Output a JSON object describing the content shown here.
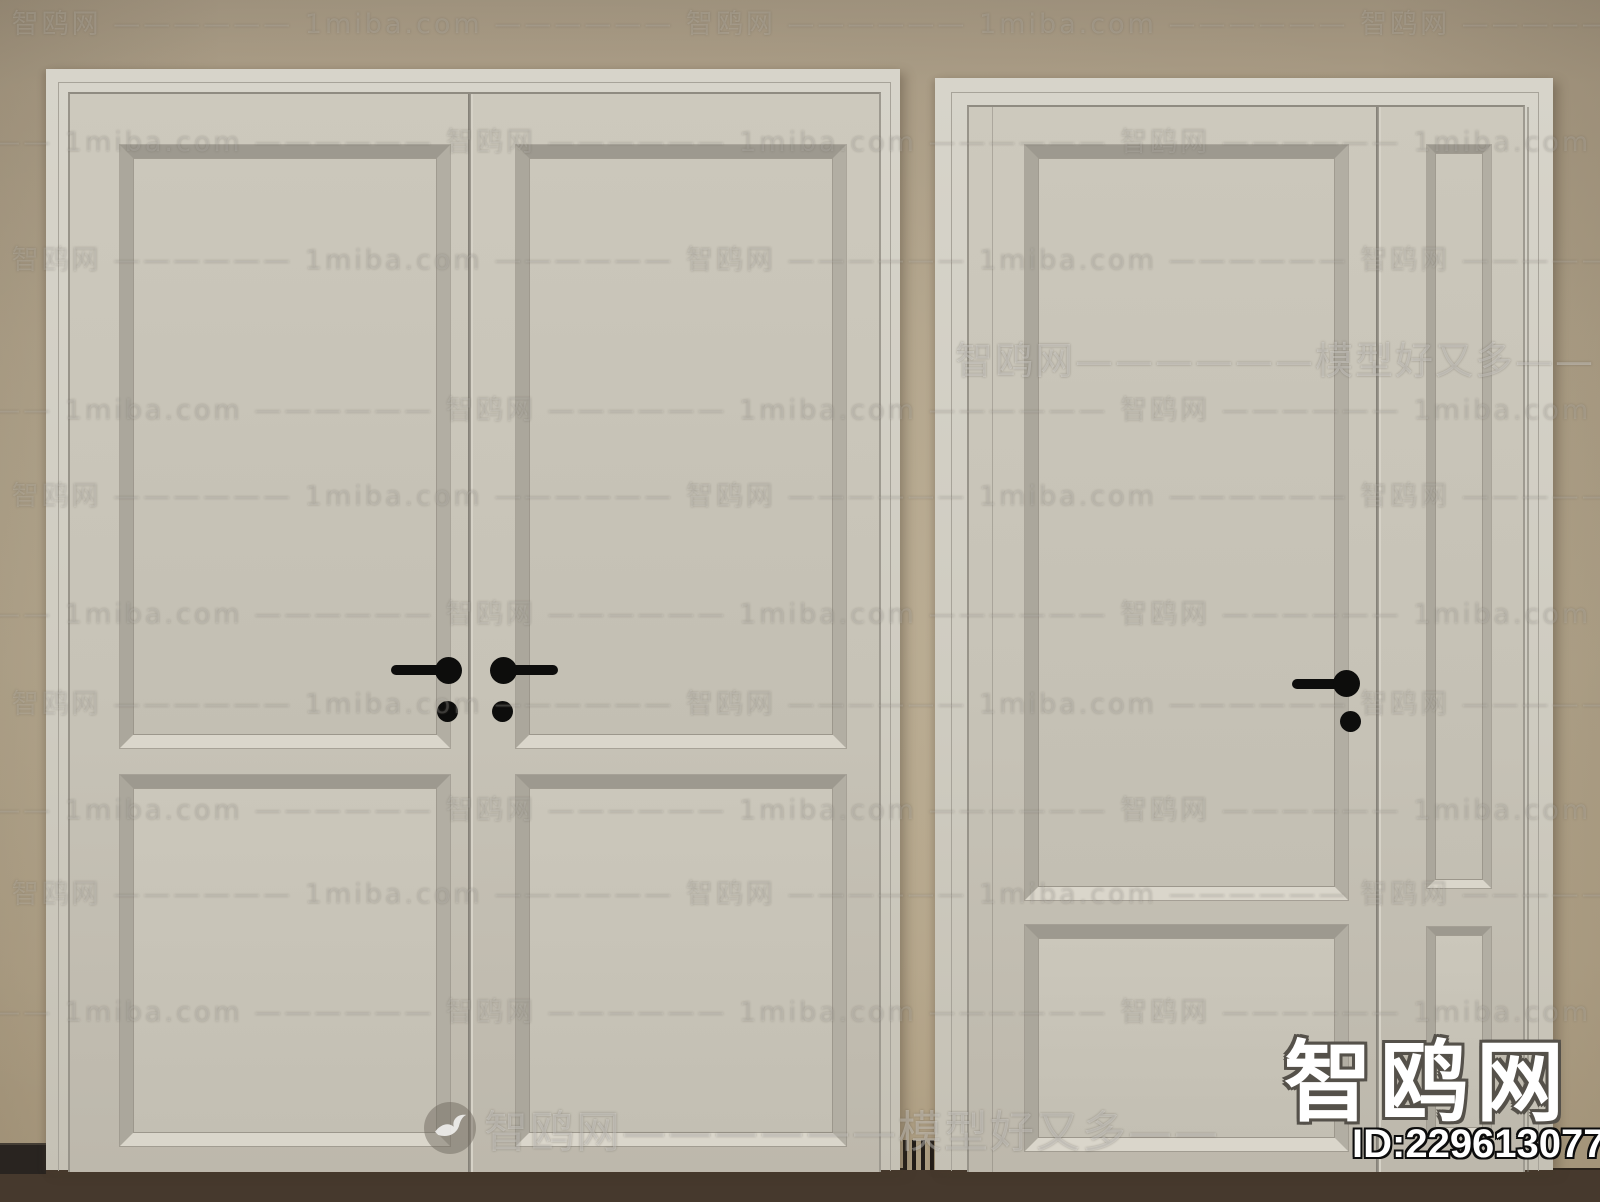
{
  "watermarks": {
    "tile_text": "—————— 智鸥网 —————— 1miba.com —————— 智鸥网 —————— 1miba.com —————— 智鸥网 —————— 1miba.com —————— 智鸥网 —————— 1miba.com —————— 智鸥网 —————— 1miba.com",
    "banner_right": "智鸥网——————模型好又多——",
    "banner_center": "智鸥网——————模型好又多——",
    "site_name": "智鸥网",
    "model_id": "ID:229613077"
  },
  "colors": {
    "wall": "#b2a489",
    "door_surface": "#c9c5b9",
    "door_frame": "#d1cec3",
    "panel_bevel_shadow": "#9d998f",
    "panel_bevel_highlight": "#dad6cb",
    "floor": "#46392d",
    "baseboard": "#292420",
    "handle": "#0d0d0c",
    "watermark_text": "#ffffff"
  }
}
